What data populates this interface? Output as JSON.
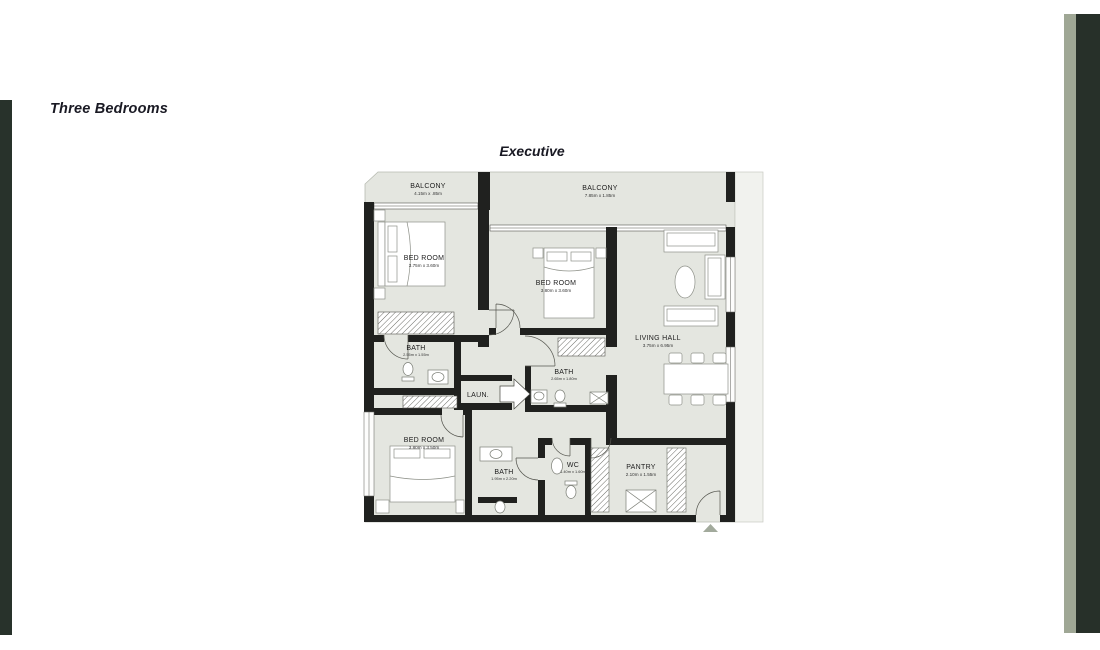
{
  "page": {
    "title": "Three Bedrooms",
    "plan_title": "Executive"
  },
  "colors": {
    "left_bar": "#28322b",
    "right_bar_dark": "#273029",
    "right_bar_light": "#9fa795",
    "plan_fill": "#e4e6e0",
    "wall": "#20211f",
    "entry_arrow": "#a2aa9c"
  },
  "rooms": {
    "balcony1": {
      "name": "BALCONY",
      "dims": "4.15m x .85m"
    },
    "balcony2": {
      "name": "BALCONY",
      "dims": "7.85m x 1.85m"
    },
    "bedroom1": {
      "name": "BED ROOM",
      "dims": "3.75m x 3.60m"
    },
    "bedroom2": {
      "name": "BED ROOM",
      "dims": "3.80m x 3.60m"
    },
    "living": {
      "name": "LIVING HALL",
      "dims": "3.75m x 6.95m"
    },
    "bath1": {
      "name": "BATH",
      "dims": "2.55m x 1.55m"
    },
    "bath2": {
      "name": "BATH",
      "dims": "2.65m x 1.80m"
    },
    "laundry": {
      "name": "LAUN."
    },
    "bedroom3": {
      "name": "BED ROOM",
      "dims": "3.80m x 3.50m"
    },
    "bath3": {
      "name": "BATH",
      "dims": "1.95m x 2.20m"
    },
    "wc": {
      "name": "WC",
      "dims": "1.40m x 1.60m"
    },
    "pantry": {
      "name": "PANTRY",
      "dims": "2.10m x 1.55m"
    }
  }
}
